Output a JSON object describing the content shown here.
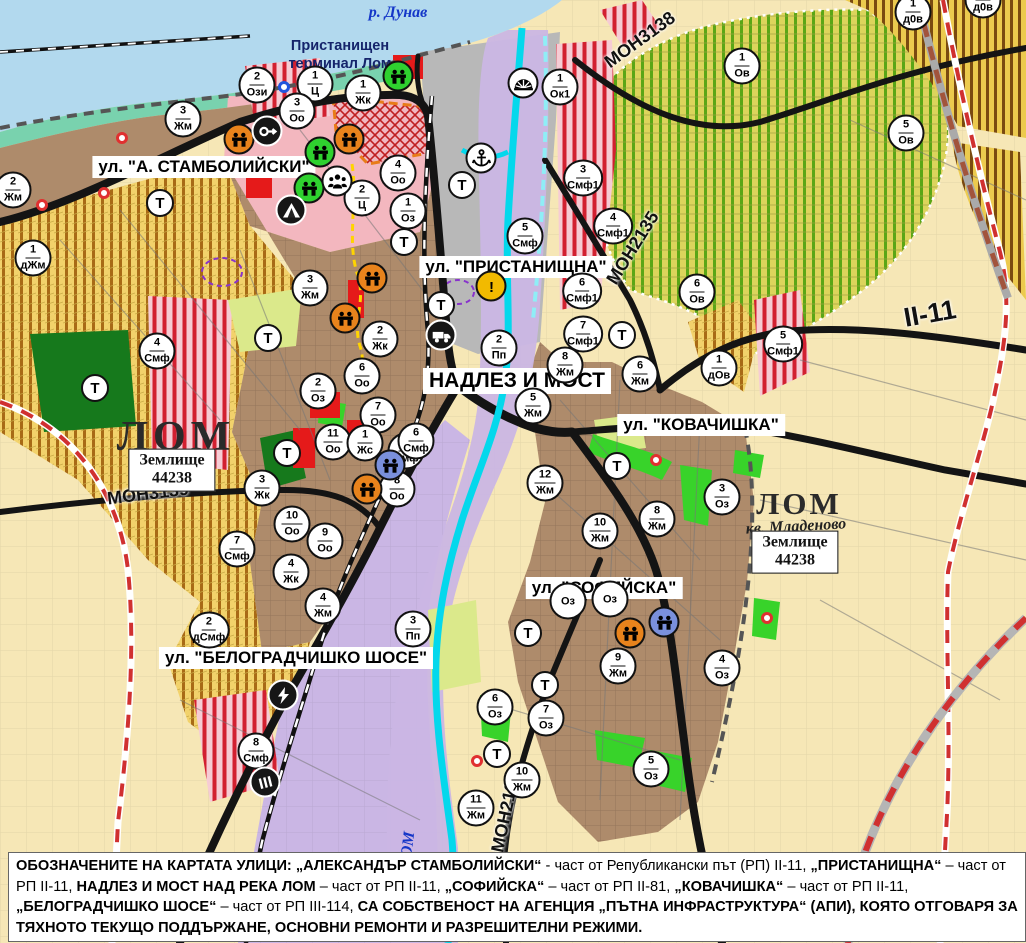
{
  "map": {
    "t_label": "Т",
    "street_labels": [
      {
        "text": "ул. \"А. СТАМБОЛИЙСКИ\"",
        "x": 204,
        "y": 167,
        "big": false
      },
      {
        "text": "ул. \"ПРИСТАНИЩНА\"",
        "x": 516,
        "y": 267,
        "big": false
      },
      {
        "text": "НАДЛЕЗ И МОСТ",
        "x": 517,
        "y": 381,
        "big": true
      },
      {
        "text": "ул. \"КОВАЧИШКА\"",
        "x": 701,
        "y": 425,
        "big": false
      },
      {
        "text": "ул. \"СОФИЙСКА\"",
        "x": 604,
        "y": 588,
        "big": false
      },
      {
        "text": "ул. \"БЕЛОГРАДЧИШКО ШОСЕ\"",
        "x": 296,
        "y": 658,
        "big": false
      }
    ],
    "place_labels": [
      {
        "text": "р. Дунав",
        "x": 398,
        "y": 13,
        "cls": "river",
        "rot": 0
      },
      {
        "text": "Пристанищен терминал Лом",
        "x": 340,
        "y": 55,
        "cls": "terminal",
        "rot": 0
      },
      {
        "text": "ЛОМ",
        "x": 176,
        "y": 437,
        "cls": "lom-big",
        "rot": 0
      },
      {
        "text": "ЛОМ",
        "x": 799,
        "y": 504,
        "cls": "lom-small",
        "rot": 0
      },
      {
        "text": "кв. Младеново",
        "x": 796,
        "y": 527,
        "cls": "kv",
        "rot": -3
      },
      {
        "text": "МОН3139",
        "x": 148,
        "y": 494,
        "cls": "ref",
        "rot": -7
      },
      {
        "text": "МОН3138",
        "x": 640,
        "y": 40,
        "cls": "ref",
        "rot": -36
      },
      {
        "text": "МОН2135",
        "x": 633,
        "y": 248,
        "cls": "ref",
        "rot": -58
      },
      {
        "text": "МОН2136",
        "x": 506,
        "y": 812,
        "cls": "ref",
        "rot": -78
      },
      {
        "text": "II-11",
        "x": 930,
        "y": 314,
        "cls": "ref bigref",
        "rot": -10
      },
      {
        "text": "р. ЛОМ",
        "x": 407,
        "y": 858,
        "cls": "river",
        "rot": -83
      }
    ],
    "zemlishte_boxes": [
      {
        "line1": "Землище",
        "line2": "44238",
        "x": 172,
        "y": 470
      },
      {
        "line1": "Землище",
        "line2": "44238",
        "x": 795,
        "y": 552
      }
    ],
    "zone_markers": [
      {
        "n": "2",
        "c": "Ози",
        "x": 257,
        "y": 85
      },
      {
        "n": "1",
        "c": "Ц",
        "x": 315,
        "y": 84
      },
      {
        "n": "3",
        "c": "Оо",
        "x": 297,
        "y": 111
      },
      {
        "n": "1",
        "c": "Жк",
        "x": 363,
        "y": 93
      },
      {
        "n": "4",
        "c": "Оо",
        "x": 398,
        "y": 173
      },
      {
        "n": "2",
        "c": "Ц",
        "x": 362,
        "y": 198
      },
      {
        "n": "1",
        "c": "Оз",
        "x": 408,
        "y": 211
      },
      {
        "n": "1",
        "c": "Ок1",
        "x": 560,
        "y": 87
      },
      {
        "n": "1",
        "c": "Ов",
        "x": 742,
        "y": 66
      },
      {
        "n": "1",
        "c": "д0в",
        "x": 913,
        "y": 12
      },
      {
        "n": "1",
        "c": "д0в",
        "x": 983,
        "y": 0
      },
      {
        "n": "5",
        "c": "Ов",
        "x": 906,
        "y": 133
      },
      {
        "n": "3",
        "c": "Смф1",
        "x": 583,
        "y": 178
      },
      {
        "n": "4",
        "c": "Смф1",
        "x": 613,
        "y": 226
      },
      {
        "n": "5",
        "c": "Смф",
        "x": 525,
        "y": 236
      },
      {
        "n": "6",
        "c": "Смф1",
        "x": 582,
        "y": 291
      },
      {
        "n": "7",
        "c": "Смф1",
        "x": 583,
        "y": 334
      },
      {
        "n": "2",
        "c": "Пп",
        "x": 499,
        "y": 348
      },
      {
        "n": "6",
        "c": "Ов",
        "x": 697,
        "y": 292
      },
      {
        "n": "1",
        "c": "дОв",
        "x": 719,
        "y": 368
      },
      {
        "n": "5",
        "c": "Смф1",
        "x": 783,
        "y": 344
      },
      {
        "n": "2",
        "c": "Жм",
        "x": 13,
        "y": 190
      },
      {
        "n": "1",
        "c": "дЖм",
        "x": 33,
        "y": 258
      },
      {
        "n": "3",
        "c": "Жм",
        "x": 183,
        "y": 119
      },
      {
        "n": "3",
        "c": "Жм",
        "x": 310,
        "y": 288
      },
      {
        "n": "4",
        "c": "Смф",
        "x": 157,
        "y": 351
      },
      {
        "n": "2",
        "c": "Жк",
        "x": 380,
        "y": 339
      },
      {
        "n": "2",
        "c": "Оз",
        "x": 318,
        "y": 391
      },
      {
        "n": "6",
        "c": "Оо",
        "x": 362,
        "y": 376
      },
      {
        "n": "7",
        "c": "Оо",
        "x": 378,
        "y": 415
      },
      {
        "n": "11",
        "c": "Оо",
        "x": 333,
        "y": 442
      },
      {
        "n": "1",
        "c": "Жс",
        "x": 365,
        "y": 443
      },
      {
        "n": "5",
        "c": "Смф",
        "x": 406,
        "y": 451
      },
      {
        "n": "3",
        "c": "Жк",
        "x": 262,
        "y": 488
      },
      {
        "n": "8",
        "c": "Оо",
        "x": 397,
        "y": 489
      },
      {
        "n": "10",
        "c": "Оо",
        "x": 292,
        "y": 524
      },
      {
        "n": "9",
        "c": "Оо",
        "x": 325,
        "y": 541
      },
      {
        "n": "7",
        "c": "Смф",
        "x": 237,
        "y": 549
      },
      {
        "n": "4",
        "c": "Жк",
        "x": 291,
        "y": 572
      },
      {
        "n": "4",
        "c": "Жм",
        "x": 323,
        "y": 606
      },
      {
        "n": "2",
        "c": "дСмф",
        "x": 209,
        "y": 630
      },
      {
        "n": "3",
        "c": "Пп",
        "x": 413,
        "y": 629
      },
      {
        "n": "8",
        "c": "Смф",
        "x": 256,
        "y": 751
      },
      {
        "n": "8",
        "c": "Жм",
        "x": 565,
        "y": 365
      },
      {
        "n": "5",
        "c": "Жм",
        "x": 533,
        "y": 406
      },
      {
        "n": "6",
        "c": "Жм",
        "x": 640,
        "y": 374
      },
      {
        "n": "12",
        "c": "Жм",
        "x": 545,
        "y": 483
      },
      {
        "n": "6",
        "c": "Смф",
        "x": 416,
        "y": 441
      },
      {
        "n": "3",
        "c": "Оз",
        "x": 722,
        "y": 497
      },
      {
        "n": "8",
        "c": "Жм",
        "x": 657,
        "y": 519
      },
      {
        "n": "10",
        "c": "Жм",
        "x": 600,
        "y": 531
      },
      {
        "n": "9",
        "c": "Жм",
        "x": 618,
        "y": 666
      },
      {
        "n": "4",
        "c": "Оз",
        "x": 722,
        "y": 668
      },
      {
        "n": "",
        "c": "Оз",
        "x": 568,
        "y": 601
      },
      {
        "n": "",
        "c": "Оз",
        "x": 610,
        "y": 599
      },
      {
        "n": "6",
        "c": "Оз",
        "x": 495,
        "y": 707
      },
      {
        "n": "7",
        "c": "Оз",
        "x": 546,
        "y": 718
      },
      {
        "n": "10",
        "c": "Жм",
        "x": 522,
        "y": 780
      },
      {
        "n": "11",
        "c": "Жм",
        "x": 476,
        "y": 808
      },
      {
        "n": "5",
        "c": "Оз",
        "x": 651,
        "y": 769
      }
    ],
    "t_markers": [
      {
        "x": 160,
        "y": 203
      },
      {
        "x": 404,
        "y": 242
      },
      {
        "x": 462,
        "y": 185
      },
      {
        "x": 441,
        "y": 305
      },
      {
        "x": 268,
        "y": 338
      },
      {
        "x": 95,
        "y": 388
      },
      {
        "x": 287,
        "y": 453
      },
      {
        "x": 622,
        "y": 335
      },
      {
        "x": 617,
        "y": 466
      },
      {
        "x": 528,
        "y": 633
      },
      {
        "x": 545,
        "y": 685
      },
      {
        "x": 497,
        "y": 754
      }
    ],
    "poi_icons": [
      {
        "type": "monument",
        "variant": "green",
        "x": 398,
        "y": 76
      },
      {
        "type": "monument",
        "variant": "green",
        "x": 320,
        "y": 152
      },
      {
        "type": "monument",
        "variant": "green",
        "x": 309,
        "y": 188
      },
      {
        "type": "monument",
        "variant": "orange",
        "x": 239,
        "y": 139
      },
      {
        "type": "monument",
        "variant": "orange",
        "x": 349,
        "y": 139
      },
      {
        "type": "monument",
        "variant": "orange",
        "x": 372,
        "y": 278
      },
      {
        "type": "monument",
        "variant": "orange",
        "x": 345,
        "y": 318
      },
      {
        "type": "monument",
        "variant": "orange",
        "x": 367,
        "y": 489
      },
      {
        "type": "monument",
        "variant": "blue",
        "x": 390,
        "y": 465
      },
      {
        "type": "monument",
        "variant": "orange",
        "x": 630,
        "y": 633
      },
      {
        "type": "monument",
        "variant": "blue",
        "x": 664,
        "y": 622
      },
      {
        "type": "key",
        "variant": "dark",
        "x": 267,
        "y": 131
      },
      {
        "type": "tent",
        "variant": "dark",
        "x": 291,
        "y": 210
      },
      {
        "type": "people",
        "variant": "light",
        "x": 337,
        "y": 181
      },
      {
        "type": "anchor",
        "variant": "light",
        "x": 481,
        "y": 158
      },
      {
        "type": "weir",
        "variant": "light",
        "x": 523,
        "y": 83
      },
      {
        "type": "warning",
        "variant": "yellow",
        "x": 491,
        "y": 286
      },
      {
        "type": "truck",
        "variant": "dark",
        "x": 441,
        "y": 335
      },
      {
        "type": "lightning",
        "variant": "dark",
        "x": 283,
        "y": 695
      },
      {
        "type": "station",
        "variant": "dark",
        "x": 265,
        "y": 782
      }
    ],
    "red_dots": [
      {
        "x": 122,
        "y": 138
      },
      {
        "x": 104,
        "y": 193
      },
      {
        "x": 42,
        "y": 205
      },
      {
        "x": 656,
        "y": 460
      },
      {
        "x": 477,
        "y": 761
      },
      {
        "x": 767,
        "y": 618
      }
    ],
    "blue_dots": [
      {
        "x": 284,
        "y": 87
      }
    ],
    "colors": {
      "water": "#b2d9ee",
      "shore": "#79d2ae",
      "urban_brown": "#ae8b6b",
      "center_pink": "#f3b7bf",
      "production_purple": "#cab6e4",
      "port_grey": "#b8b8b8",
      "park_green": "#38d32a",
      "forest_green": "#16791c",
      "smf_red": "#d22030",
      "river_cyan": "#04d8ec",
      "boundary_red": "#d03030",
      "monument_orange": "#e8831c",
      "monument_green": "#2fd12f",
      "monument_blue": "#7a90dc"
    },
    "footer": {
      "segments": [
        {
          "text": "ОБОЗНАЧЕНИТЕ НА КАРТАТА УЛИЦИ: „АЛЕКСАНДЪР СТАМБОЛИЙСКИ“",
          "bold": true
        },
        {
          "text": " - част от Републикански път (РП) II-11, ",
          "bold": false
        },
        {
          "text": "„ПРИСТАНИЩНА“",
          "bold": true
        },
        {
          "text": " – част от РП II-11, ",
          "bold": false
        },
        {
          "text": "НАДЛЕЗ И МОСТ НАД РЕКА ЛОМ",
          "bold": true
        },
        {
          "text": " – част от РП II-11, ",
          "bold": false
        },
        {
          "text": "„СОФИЙСКА“",
          "bold": true
        },
        {
          "text": " – част от РП II-81, ",
          "bold": false
        },
        {
          "text": "„КОВАЧИШКА“",
          "bold": true
        },
        {
          "text": " – част от РП II-11, ",
          "bold": false
        },
        {
          "text": "„БЕЛОГРАДЧИШКО ШОСЕ“",
          "bold": true
        },
        {
          "text": " – част от РП III-114, ",
          "bold": false
        },
        {
          "text": "СА СОБСТВЕНОСТ НА АГЕНЦИЯ „ПЪТНА ИНФРАСТРУКТУРА“ (АПИ), КОЯТО ОТГОВАРЯ ЗА ТЯХНОТО ТЕКУЩО ПОДДЪРЖАНЕ, ОСНОВНИ РЕМОНТИ И РАЗРЕШИТЕЛНИ РЕЖИМИ.",
          "bold": true
        }
      ]
    }
  }
}
